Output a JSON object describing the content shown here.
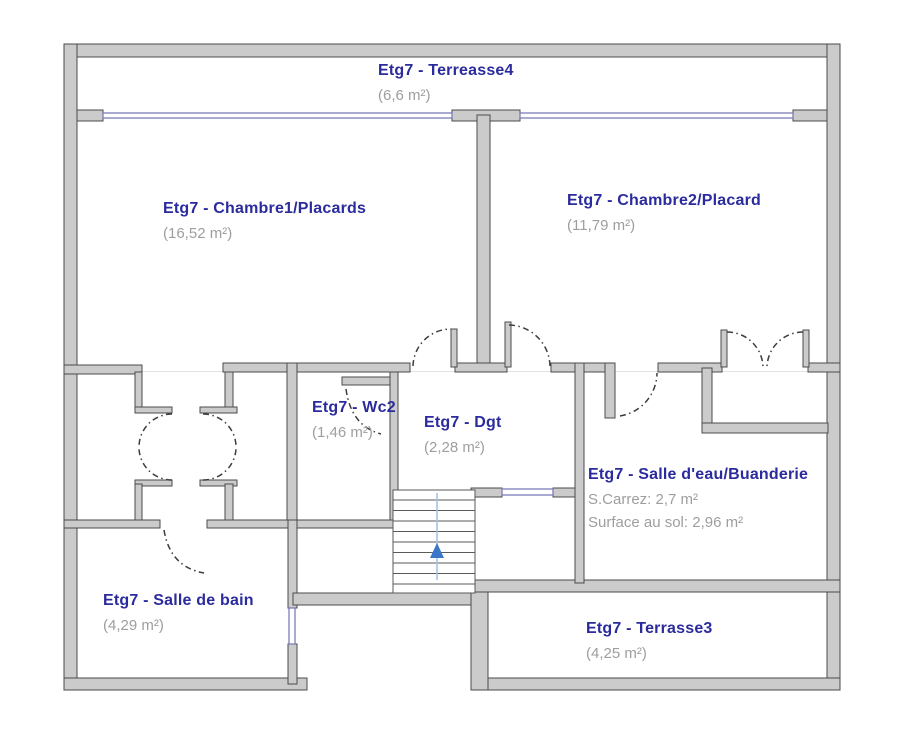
{
  "plan": {
    "floor": "Etg7",
    "stairs": {
      "direction": "up"
    }
  },
  "rooms": [
    {
      "id": "terreasse4",
      "name": "Etg7 - Terreasse4",
      "area_lines": [
        "(6,6 m²)"
      ]
    },
    {
      "id": "chambre1",
      "name": "Etg7 - Chambre1/Placards",
      "area_lines": [
        "(16,52 m²)"
      ]
    },
    {
      "id": "chambre2",
      "name": "Etg7 - Chambre2/Placard",
      "area_lines": [
        "(11,79 m²)"
      ]
    },
    {
      "id": "wc2",
      "name": "Etg7 - Wc2",
      "area_lines": [
        "(1,46 m²)"
      ]
    },
    {
      "id": "dgt",
      "name": "Etg7 - Dgt",
      "area_lines": [
        "(2,28 m²)"
      ]
    },
    {
      "id": "salle_eau",
      "name": "Etg7 - Salle d'eau/Buanderie",
      "area_lines": [
        "S.Carrez: 2,7 m²",
        "Surface au sol: 2,96 m²"
      ]
    },
    {
      "id": "salle_de_bain",
      "name": "Etg7 - Salle de bain",
      "area_lines": [
        "(4,29 m²)"
      ]
    },
    {
      "id": "terrasse3",
      "name": "Etg7 - Terrasse3",
      "area_lines": [
        "(4,25 m²)"
      ]
    }
  ],
  "colors": {
    "wall_fill": "#cbcbcb",
    "wall_stroke": "#4b4b4b",
    "window_blue": "#7c7cba",
    "door_arc": "#3d3d3d",
    "label_blue": "#2b2b9e",
    "area_gray": "#9e9e9e",
    "stair_line_blue": "#a8c2e4",
    "stair_arrow_blue": "#3a76c9"
  }
}
